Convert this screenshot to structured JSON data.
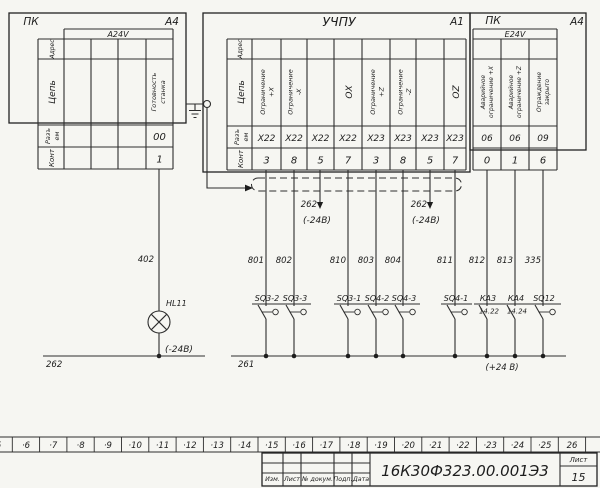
{
  "pk_left": {
    "title": "ПК",
    "zone": "А4",
    "header": "A24V",
    "rows": {
      "address": "Адрес",
      "circuit": "Цепь",
      "conn1": "Разъ",
      "conn2": "ем",
      "contact": "Конт"
    },
    "signal": {
      "line1": "Готовность",
      "line2": "станка",
      "connector": "00",
      "pin": "1"
    }
  },
  "uchpu": {
    "title": "УЧПУ",
    "zone": "А1",
    "rows": {
      "address": "Адрес",
      "circuit": "Цепь",
      "conn1": "Разъ",
      "conn2": "ем",
      "contact": "Конт"
    },
    "columns": [
      {
        "c1": "Ограничение",
        "c2": "+X",
        "conn": "X22",
        "pin": "3"
      },
      {
        "c1": "Ограничение",
        "c2": "-X",
        "conn": "X22",
        "pin": "8"
      },
      {
        "c1": "",
        "c2": "",
        "conn": "X22",
        "pin": "5"
      },
      {
        "c1": "ОХ",
        "c2": "",
        "conn": "X22",
        "pin": "7"
      },
      {
        "c1": "Ограничение",
        "c2": "+Z",
        "conn": "X23",
        "pin": "3"
      },
      {
        "c1": "Ограничение",
        "c2": "-Z",
        "conn": "X23",
        "pin": "8"
      },
      {
        "c1": "",
        "c2": "",
        "conn": "X23",
        "pin": "5"
      },
      {
        "c1": "ОZ",
        "c2": "",
        "conn": "X23",
        "pin": "7"
      }
    ]
  },
  "pk_right": {
    "title": "ПК",
    "zone": "А4",
    "header": "E24V",
    "columns": [
      {
        "c1": "Аварийное",
        "c2": "ограничение +X",
        "conn": "06",
        "pin": "0"
      },
      {
        "c1": "Аварийное",
        "c2": "ограничение +Z",
        "conn": "06",
        "pin": "1"
      },
      {
        "c1": "Ограждение",
        "c2": "закрыто",
        "conn": "09",
        "pin": "6"
      }
    ]
  },
  "wires": {
    "lamp_wire": "402",
    "numbers": [
      "801",
      "802",
      "810",
      "803",
      "804",
      "811",
      "812",
      "813",
      "335"
    ]
  },
  "taps": [
    {
      "num": "262",
      "volt": "(-24В)"
    },
    {
      "num": "262",
      "volt": "(-24В)"
    }
  ],
  "lamp": {
    "label": "HL11",
    "volt": "(-24В)"
  },
  "buses": {
    "left": "262",
    "right": "261",
    "plus": "(+24 В)"
  },
  "switches": [
    {
      "label": "SQ3-2"
    },
    {
      "label": "SQ3-3"
    },
    {
      "label": "SQ3-1"
    },
    {
      "label": "SQ4-2"
    },
    {
      "label": "SQ4-3"
    },
    {
      "label": "SQ4-1"
    },
    {
      "label": "КА3",
      "sub": "14.22"
    },
    {
      "label": "КА4",
      "sub": "14.24"
    },
    {
      "label": "SQ12"
    }
  ],
  "ruler": [
    "5",
    "·6",
    "·7",
    "·8",
    "·9",
    "·10",
    "·11",
    "·12",
    "·13",
    "·14",
    "·15",
    "·16",
    "·17",
    "·18",
    "·19",
    "·20",
    "·21",
    "·22",
    "·23",
    "·24",
    "·25",
    "26"
  ],
  "title_block": {
    "cols": [
      "Изм.",
      "Лист",
      "№ докум.",
      "Подп.",
      "Дата"
    ],
    "doc": "16К30Ф323.00.001Э3",
    "sheet_label": "Лист",
    "sheet": "15"
  }
}
